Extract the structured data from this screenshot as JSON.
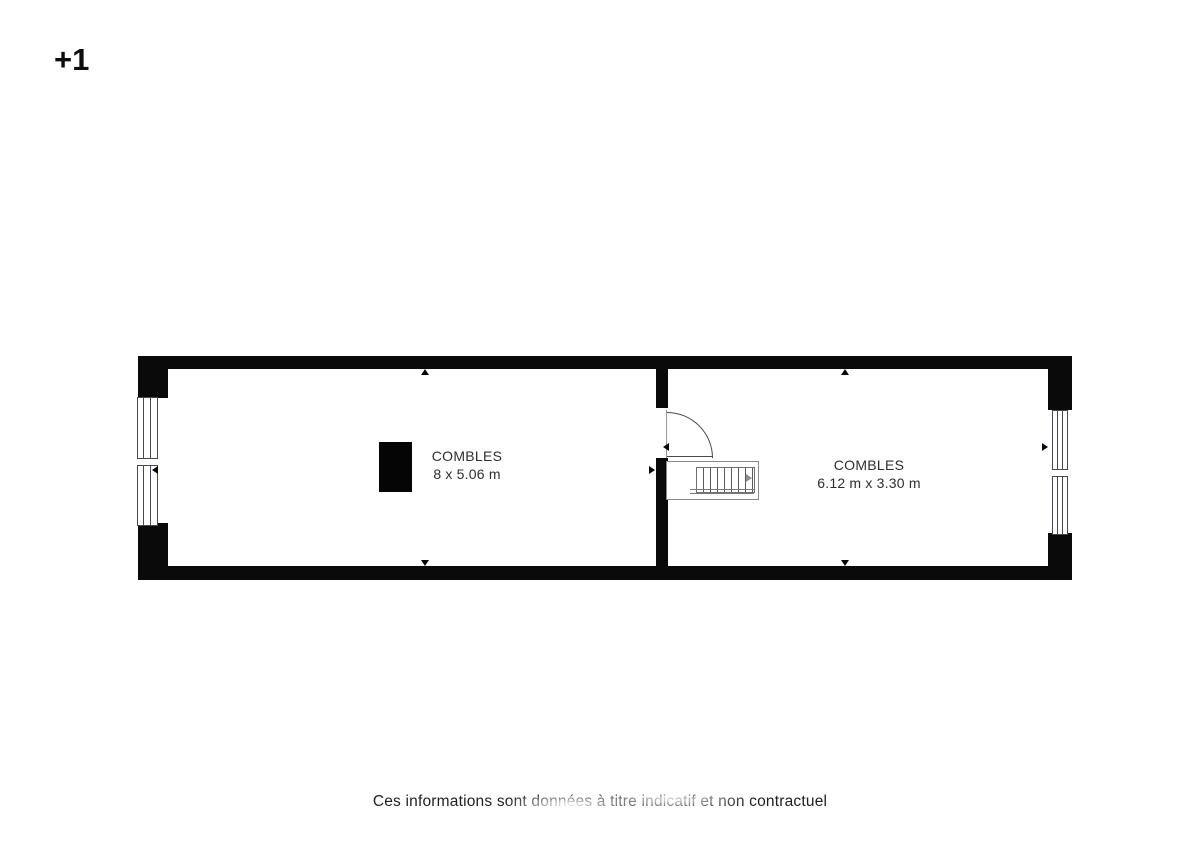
{
  "floor": {
    "label": "+1"
  },
  "rooms": [
    {
      "name": "COMBLES",
      "dimensions": "8 x 5.06 m"
    },
    {
      "name": "COMBLES",
      "dimensions": "6.12 m x 3.30 m"
    }
  ],
  "footer": {
    "disclaimer": "Ces informations sont données à titre indicatif et non contractuel"
  },
  "colors": {
    "wall": "#0a0a0a",
    "window_line": "#474756",
    "door_line": "#4a4a4a",
    "text": "#2e2e2e",
    "background": "#ffffff"
  }
}
